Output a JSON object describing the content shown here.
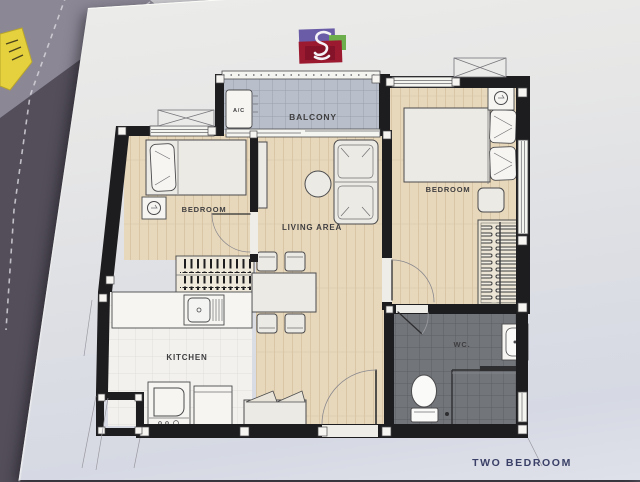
{
  "colors": {
    "fabric": "#534e5a",
    "fabric-light": "#8b8795",
    "stitch": "#d6d3da",
    "note": "#e5d13e",
    "wall": "#1d1c1e",
    "wood": "#e7d8bc",
    "wood-line": "#d8c6a6",
    "balcony-tile": "#b9bfca",
    "balcony-line": "#99a1ae",
    "kitchen-floor": "#f2f1ee",
    "kitchen-line": "#e0dfda",
    "wc-tile": "#72757a",
    "wc-line": "#5c5f64",
    "furniture-fill": "#eceae4",
    "stroke": "#4a4a4c",
    "label": "#3f3e40",
    "caption": "#3a4067"
  },
  "logo": {
    "colors": {
      "logo-purple": "#6a5ca6",
      "logo-green": "#6cae4b",
      "logo-red": "#9c1a30",
      "logo-dark-red": "#7c1127"
    }
  },
  "plan": {
    "caption": "TWO BEDROOM",
    "labels": {
      "balcony": "BALCONY",
      "ac": "A/C",
      "bedroom_left": "BEDROOM",
      "bedroom_right": "BEDROOM",
      "living": "LIVING AREA",
      "kitchen": "KITCHEN",
      "wc": "WC."
    }
  }
}
